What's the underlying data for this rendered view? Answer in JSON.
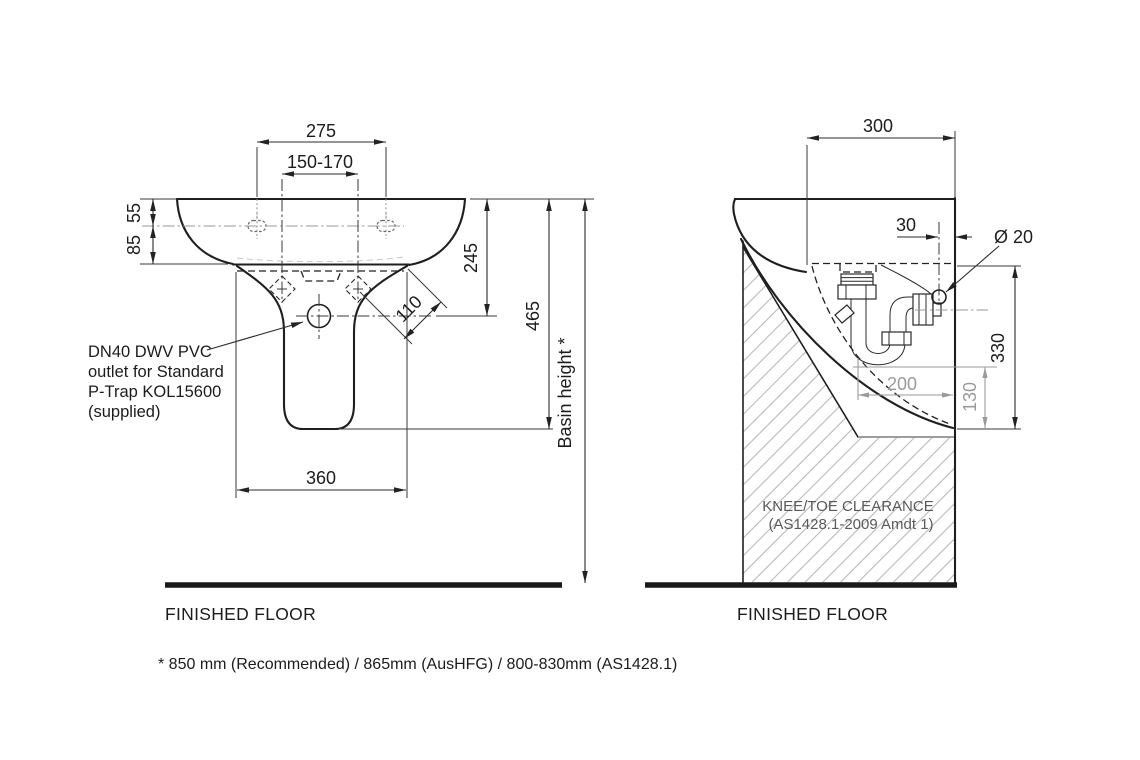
{
  "front_view": {
    "dims": {
      "mounting_width": "275",
      "fixing_centres": "150-170",
      "rim_to_holes": "55",
      "holes_to_bracket": "85",
      "rim_to_outlet": "245",
      "rim_to_pedestal_bottom": "465",
      "fixing_diagonal": "110",
      "base_width": "360",
      "basin_height_label": "Basin height *"
    },
    "note": {
      "line1": "DN40 DWV PVC",
      "line2": "outlet for Standard",
      "line3": "P-Trap KOL15600",
      "line4": "(supplied)"
    },
    "floor_label": "FINISHED FLOOR"
  },
  "side_view": {
    "dims": {
      "depth": "300",
      "supply_offset": "30",
      "supply_diameter": "Ø 20",
      "clearance_height": "330",
      "trap_depth": "200",
      "trap_clearance": "130"
    },
    "clearance": {
      "line1": "KNEE/TOE CLEARANCE",
      "line2": "(AS1428.1-2009 Amdt 1)"
    },
    "floor_label": "FINISHED FLOOR"
  },
  "footnote": "* 850 mm (Recommended) / 865mm (AusHFG) / 800-830mm (AS1428.1)",
  "colors": {
    "line": "#1f1f1f",
    "dimension": "#2b2b2b",
    "grey_dimension": "#9a9a9a",
    "hatch": "#b9b9b9",
    "clearance_text": "#5a5a5a"
  }
}
